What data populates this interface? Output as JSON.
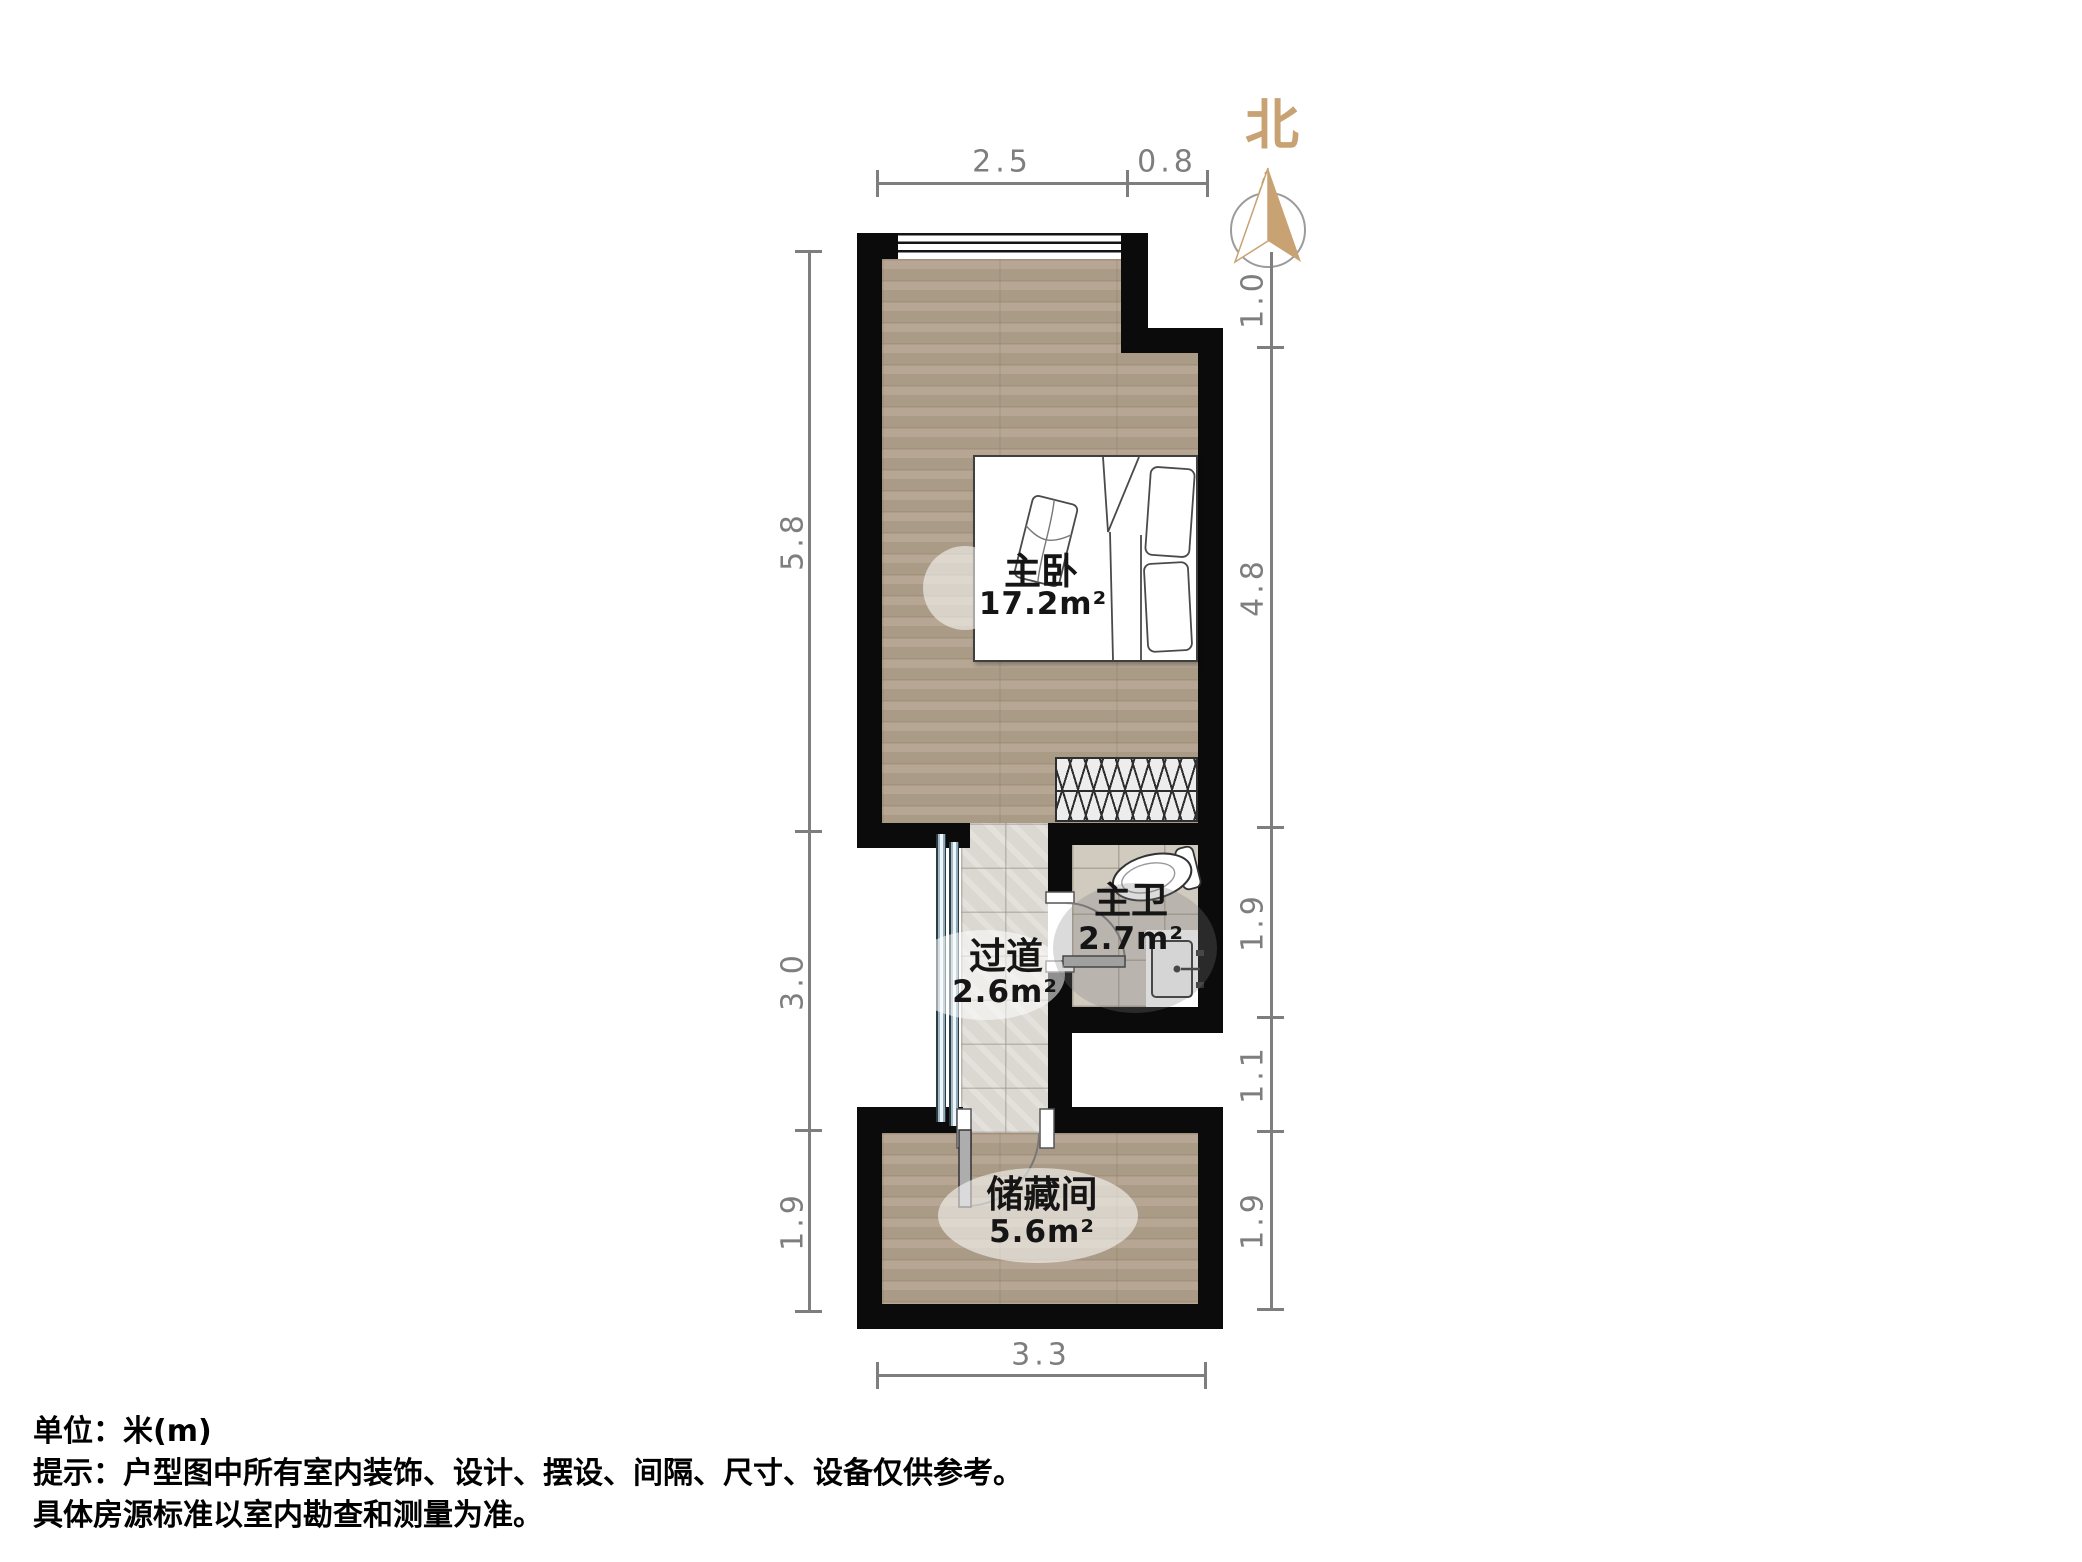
{
  "compass": {
    "north_label": "北"
  },
  "rooms": {
    "master_bedroom": {
      "name": "主卧",
      "area": "17.2m²"
    },
    "corridor": {
      "name": "过道",
      "area": "2.6m²"
    },
    "master_bath": {
      "name": "主卫",
      "area": "2.7m²"
    },
    "storage": {
      "name": "储藏间",
      "area": "5.6m²"
    }
  },
  "dimensions": {
    "top": [
      "2.5",
      "0.8"
    ],
    "bottom": [
      "3.3"
    ],
    "left": [
      "5.8",
      "3.0",
      "1.9"
    ],
    "right": [
      "1.0",
      "4.8",
      "1.9",
      "1.1",
      "1.9"
    ]
  },
  "footer": {
    "unit_line": "单位：米(m)",
    "notice_line1": "提示：户型图中所有室内装饰、设计、摆设、间隔、尺寸、设备仅供参考。",
    "notice_line2": "具体房源标准以室内勘查和测量为准。"
  },
  "colors": {
    "wall": "#0b0b0b",
    "wood_floor": "#b1a18c",
    "tile_floor": "#dbd7d1",
    "bath_tile": "#d0cabf",
    "dimension": "#7e7e7e",
    "compass_accent": "#c8a273"
  }
}
